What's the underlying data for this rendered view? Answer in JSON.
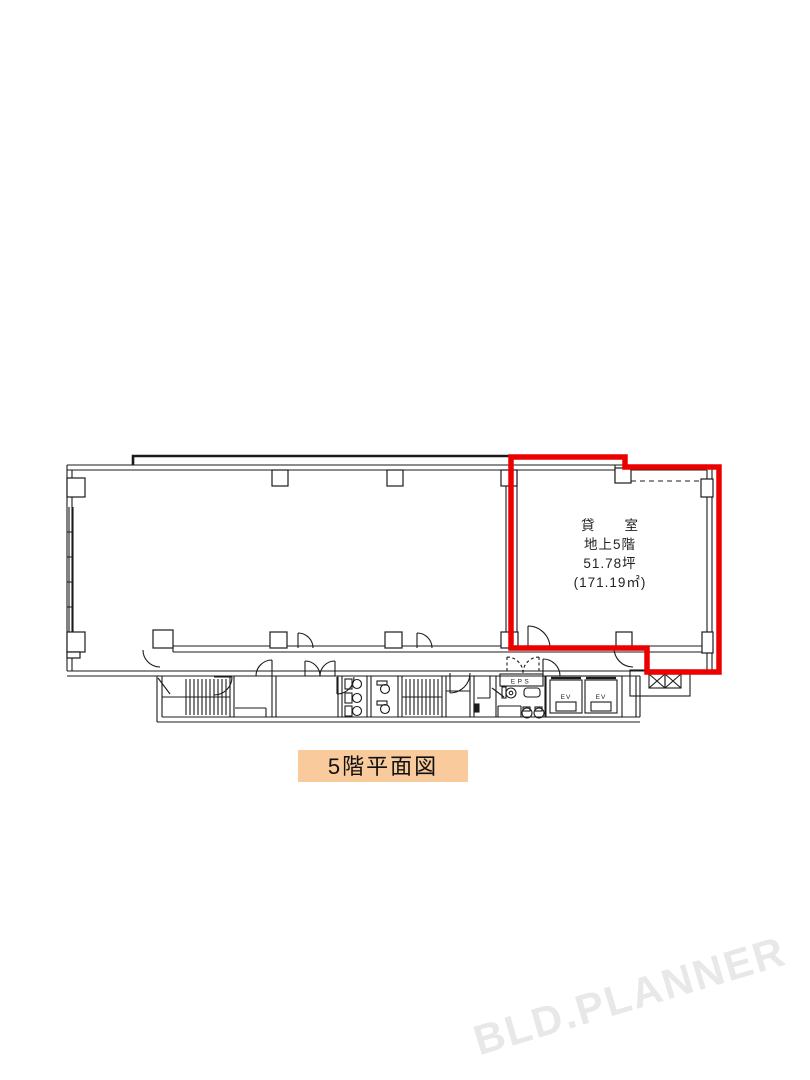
{
  "plan": {
    "highlight_color": "#ED0000",
    "line_color": "#1B1B1B",
    "rental_label": {
      "line1": "貸　　室",
      "line2": "地上5階",
      "line3": "51.78坪",
      "line4": "(171.19㎡)"
    },
    "rooms": {
      "eps_label": "EPS",
      "elevator1_label": "EV",
      "elevator2_label": "EV"
    },
    "caption": {
      "text": "5階平面図",
      "bg_color": "#F9CA9B",
      "text_color": "#111111"
    },
    "watermark": {
      "text": "BLD.PLANNER",
      "color": "#E8E8E8"
    }
  }
}
